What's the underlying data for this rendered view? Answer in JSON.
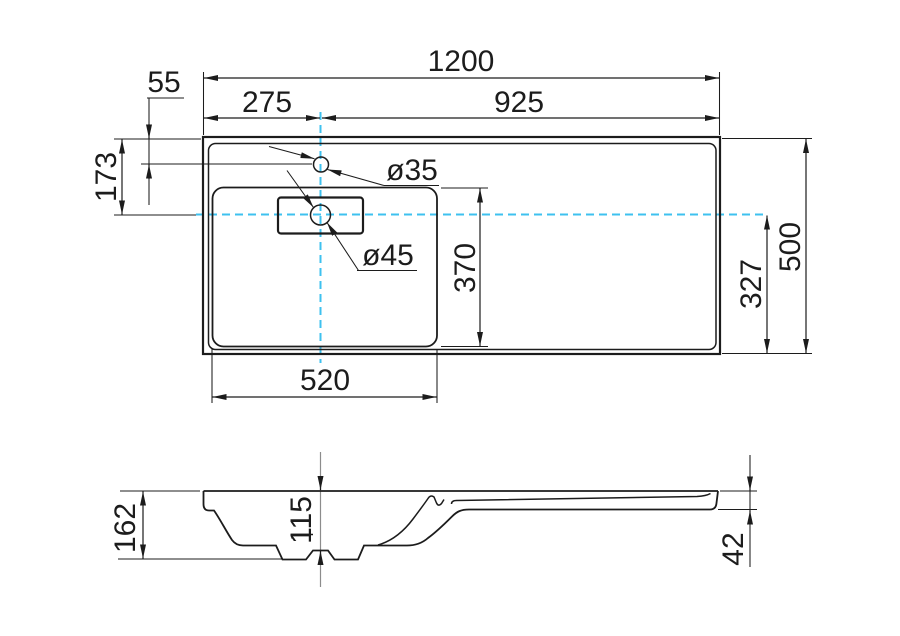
{
  "drawing": {
    "colors": {
      "ink": "#1c1c1c",
      "centerline_blue": "#3ec1ef",
      "axis_gray": "#8c8c8c",
      "background": "#ffffff"
    },
    "top": {
      "overall_width": "1200",
      "right_span": "925",
      "tap_from_left": "275",
      "tap_from_back": "55",
      "center_from_back": "173",
      "tap_hole_dia": "ø35",
      "drain_hole_dia": "ø45",
      "basin_front_back": "370",
      "center_from_front": "327",
      "overall_depth": "500",
      "basin_width": "520"
    },
    "section": {
      "overall_height": "162",
      "bowl_depth": "115",
      "deck_edge_height": "42"
    }
  }
}
